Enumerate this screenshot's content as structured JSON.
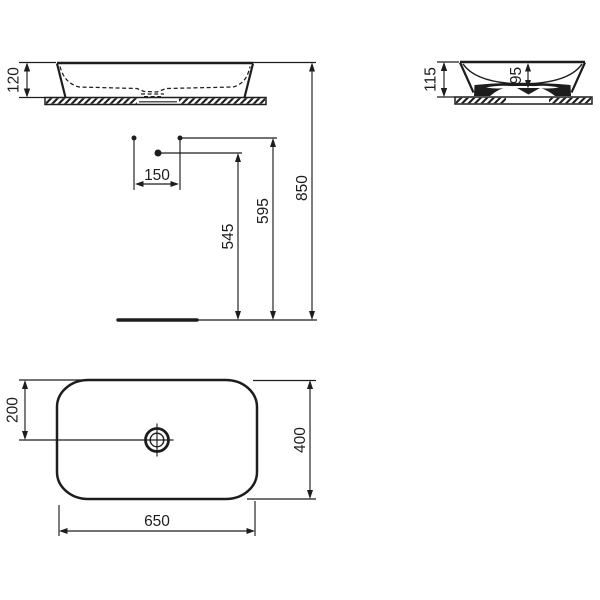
{
  "drawing": {
    "type": "washbasin-installation-technical-drawing",
    "background": "#ffffff",
    "line_color": "#1d1d1d",
    "views": {
      "front_elevation": "front elevation with countertop",
      "side_section": "side section with countertop",
      "plan": "plan view with drain"
    },
    "dimensions": {
      "basin_height_front": "120",
      "tap_hole_spacing": "150",
      "spout_outlet_height": "545",
      "tap_hole_height": "595",
      "rim_top_height": "850",
      "basin_height_side": "115",
      "bowl_inner_depth": "95",
      "drain_setback": "200",
      "basin_depth": "400",
      "basin_width": "650"
    }
  }
}
